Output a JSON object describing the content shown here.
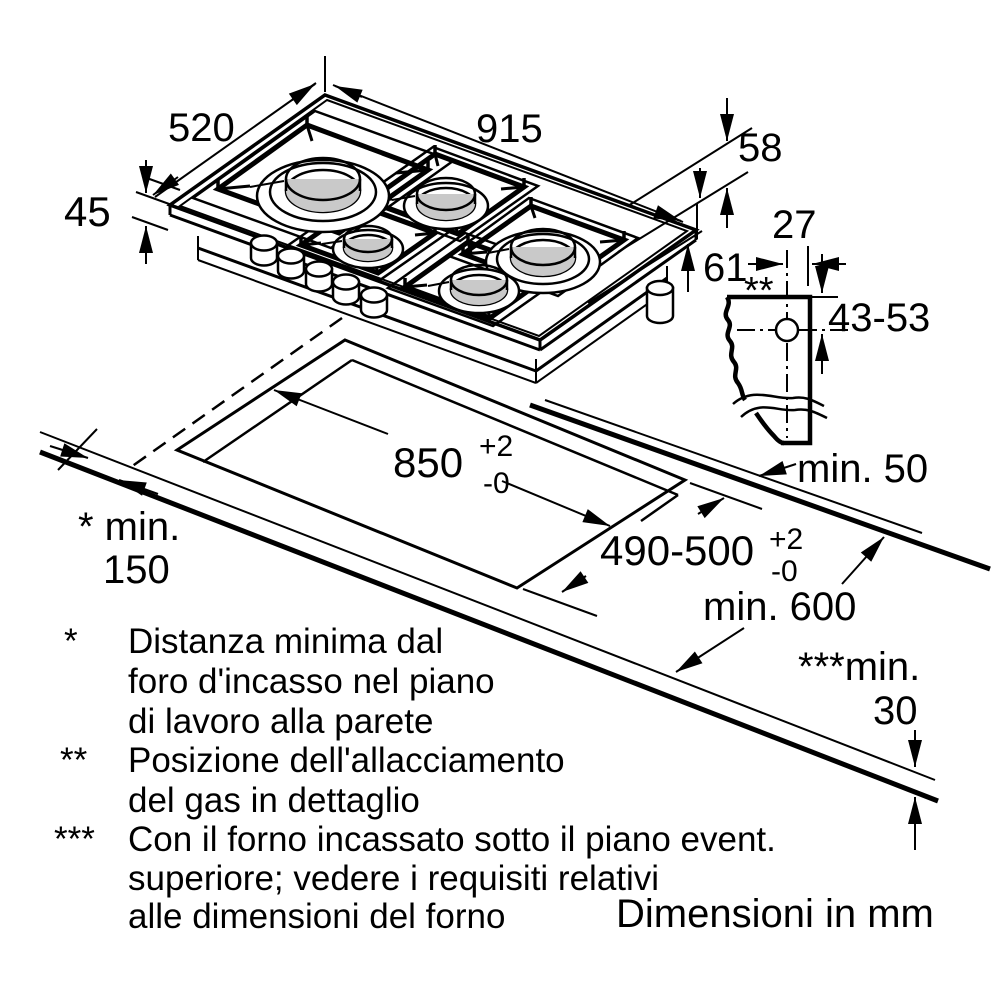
{
  "diagram": {
    "caption": "Dimensioni in mm",
    "dims": {
      "hob_width": "915",
      "hob_depth": "520",
      "hob_height": "45",
      "gas_offset_upper": "58",
      "gas_offset_lower": "61",
      "gas_center_offset": "27",
      "gas_connection_marker": "**",
      "gas_connection_depth": "43-53",
      "cutout_width": {
        "value": "850",
        "tol_plus": "+2",
        "tol_minus": "-0"
      },
      "cutout_depth": {
        "value": "490-500",
        "tol_plus": "+2",
        "tol_minus": "-0"
      },
      "rear_clearance": "min. 50",
      "side_clearance_label": "* min.",
      "side_clearance_value": "150",
      "worktop_depth": "min. 600",
      "oven_clearance_label": "***min.",
      "oven_clearance_value": "30"
    },
    "footnotes": [
      {
        "marker": "*",
        "lines": [
          "Distanza minima dal",
          "foro d'incasso nel piano",
          "di lavoro alla parete"
        ]
      },
      {
        "marker": "**",
        "lines": [
          "Posizione dell'allacciamento",
          "del gas in dettaglio"
        ]
      },
      {
        "marker": "***",
        "lines": [
          "Con il forno incassato sotto il piano event.",
          "superiore; vedere i requisiti relativi",
          "alle dimensioni del forno"
        ]
      }
    ],
    "colors": {
      "line": "#000000",
      "burner_cap": "#c9c9c9",
      "background": "#ffffff"
    }
  }
}
